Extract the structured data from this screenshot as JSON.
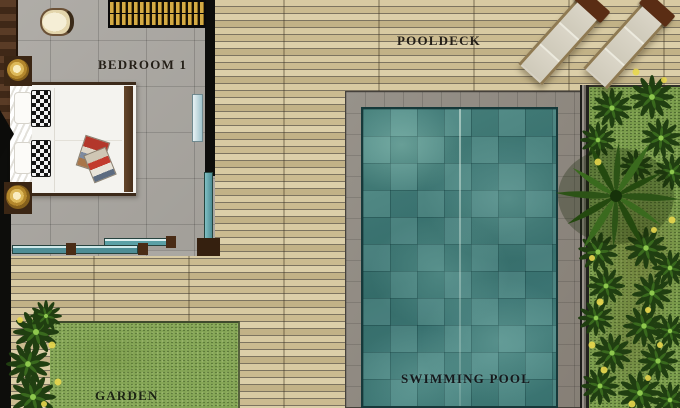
{
  "labels": {
    "bedroom": "BEDROOM 1",
    "pooldeck": "POOLDECK",
    "pool": "SWIMMING POOL",
    "garden": "GARDEN"
  },
  "objects": {
    "sun_loungers_count": 2,
    "items": [
      "double-bed",
      "checkered-pillows",
      "magazines",
      "wardrobe",
      "nightstand-lamps",
      "armchair",
      "sliding-glass-doors",
      "swimming-pool",
      "pool-coping",
      "palm-tree",
      "shrubs",
      "lawn"
    ]
  },
  "theme": {
    "deck_light": "#d8caa2",
    "deck_mid": "#cbbb90",
    "deck_light2": "#dccfa9",
    "deck_dark": "#c2b287",
    "deck_seam": "#7d7460",
    "tile_gray": "#a9a6a1",
    "pool_water": "#41807c",
    "pool_coping": "#8f8a82",
    "grass": "#86a757",
    "grass_right": "#7b9d4c",
    "wood_brown": "#5a3c26",
    "wall_black": "#0d0d0b",
    "gold": "#d4ab45",
    "glass_teal": "#4e8d95",
    "leaf_dark": "#203e11",
    "leaf_mid": "#3a6a1e",
    "leaf_light": "#8ec84e",
    "flower_yellow": "#e9d84e",
    "lounger_body": "#d6d1c3",
    "lounger_head": "#5a2d14",
    "label": "#241f17"
  }
}
